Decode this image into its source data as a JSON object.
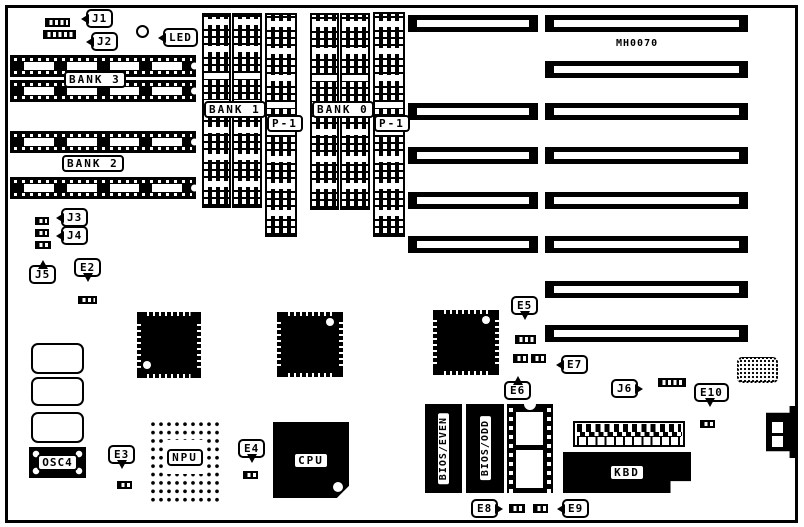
{
  "board": {
    "code": "MH0070"
  },
  "colors": {
    "ink": "#000000",
    "paper": "#ffffff"
  },
  "callouts": {
    "j1": "J1",
    "j2": "J2",
    "j3": "J3",
    "j4": "J4",
    "j5": "J5",
    "j6": "J6",
    "e2": "E2",
    "e3": "E3",
    "e4": "E4",
    "e5": "E5",
    "e6": "E6",
    "e7": "E7",
    "e8": "E8",
    "e9": "E9",
    "e10": "E10",
    "led": "LED"
  },
  "memory": {
    "bank0": "BANK 0",
    "bank1": "BANK 1",
    "bank2": "BANK 2",
    "bank3": "BANK 3",
    "p1_left": "P-1",
    "p1_right": "P-1"
  },
  "components": {
    "cpu": "CPU",
    "npu": "NPU",
    "kbd": "KBD",
    "osc4": "OSC4",
    "bios_even": "BIOS/EVEN",
    "bios_odd": "BIOS/ODD"
  }
}
